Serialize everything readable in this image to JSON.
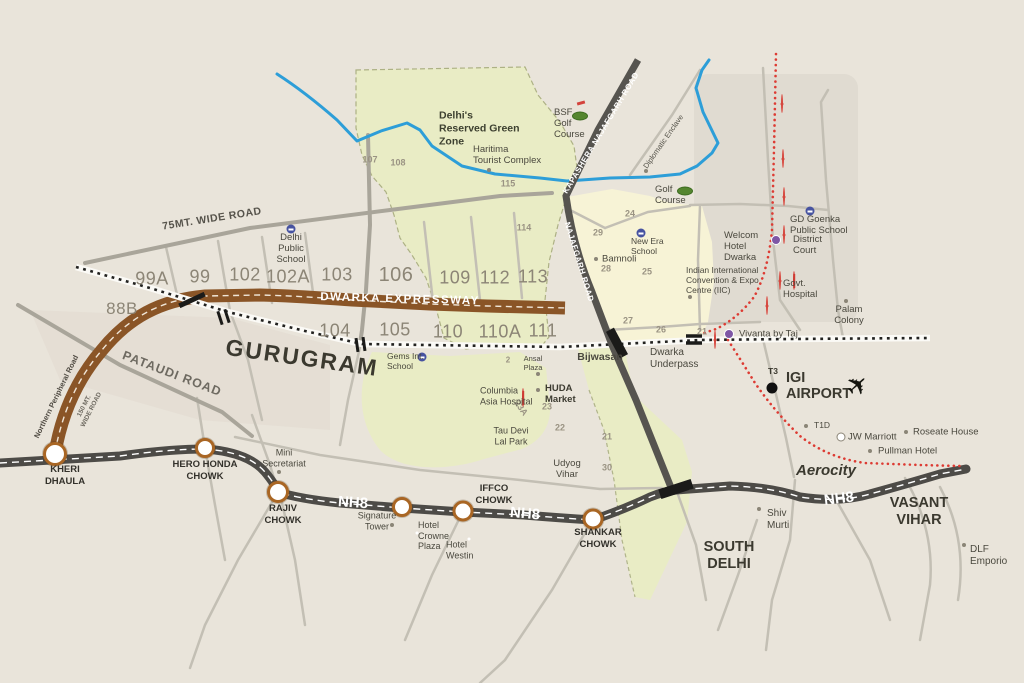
{
  "areas": {
    "gurugram": "GURUGRAM",
    "south_delhi": "SOUTH\nDELHI",
    "vasant_vihar": "VASANT\nVIHAR",
    "aerocity": "Aerocity",
    "bijwasan": "Bijwasan",
    "dwarka_underpass": "Dwarka\nUnderpass",
    "udyog_vihar": "Udyog\nVihar",
    "palam_colony": "Palam\nColony",
    "diplomatic_enclave": "Diplomatic Enclave",
    "green_zone": "Delhi's\nReserved Green\nZone",
    "bamnoli": "Bamnoli"
  },
  "roads": {
    "dwarka_expressway": "DWARKA EXPRESSWAY",
    "nh8": "NH8",
    "pataudi": "PATAUDI ROAD",
    "wide75": "75MT. WIDE ROAD",
    "wide150": "150 MT.\nWIDE ROAD",
    "npr": "Northern Peripheral Road",
    "kapashera": "KAPASHERA NAJAFGARH ROAD",
    "najafgarh": "NAJAFGARH ROAD"
  },
  "junctions": {
    "kheri": "KHERI\nDHAULA",
    "hero": "HERO HONDA\nCHOWK",
    "rajiv": "RAJIV\nCHOWK",
    "iffco": "IFFCO\nCHOWK",
    "shankar": "SHANKAR\nCHOWK"
  },
  "places": {
    "dps": "Delhi\nPublic\nSchool",
    "haritima": "Haritima\nTourist Complex",
    "bsf_golf": "BSF\nGolf\nCourse",
    "golf": "Golf\nCourse",
    "new_era": "New Era\nSchool",
    "welcom": "Welcom\nHotel\nDwarka",
    "iicc": "Indian International\nConvention & Expo\nCentre (IIC)",
    "gd_goenka": "GD Goenka\nPublic School",
    "district_court": "District\nCourt",
    "govt_hospital": "Govt.\nHospital",
    "vivanta": "Vivanta by Taj",
    "gems": "Gems Int.\nSchool",
    "columbia": "Columbia\nAsia Hospital",
    "huda": "HUDA\nMarket",
    "ansal": "Ansal\nPlaza",
    "tau_devi": "Tau Devi\nLal Park",
    "mini_sec": "Mini\nSecretariat",
    "signature": "Signature\nTower",
    "crowne": "Hotel\nCrowne\nPlaza",
    "westin": "Hotel\nWestin",
    "igi": "IGI\nAIRPORT",
    "t3": "T3",
    "t1d": "T1D",
    "jw": "JW Marriott",
    "roseate": "Roseate House",
    "pullman": "Pullman Hotel",
    "shiv_murti": "Shiv\nMurti",
    "dlf": "DLF\nEmporio"
  },
  "sectors": {
    "s99a": "99A",
    "s99": "99",
    "s102": "102",
    "s102a": "102A",
    "s103": "103",
    "s106": "106",
    "s109": "109",
    "s112": "112",
    "s113": "113",
    "s88b": "88B",
    "s104": "104",
    "s105": "105",
    "s110": "110",
    "s110a": "110A",
    "s111": "111",
    "s107": "107",
    "s108": "108",
    "s115": "115",
    "s114": "114",
    "s24": "24",
    "s29": "29",
    "s28": "28",
    "s25": "25",
    "s27": "27",
    "s26": "26",
    "s21a": "21",
    "s23": "23",
    "s23a": "23A",
    "s22": "22",
    "s21b": "21",
    "s30": "30",
    "s2": "2"
  },
  "colors": {
    "expressway_brown": "#8a5527",
    "nh8_gray": "#4d4b47",
    "metro_red": "#dd3b33",
    "river_blue": "#2d9ed8",
    "green_zone_fill": "#e9ecc5",
    "dwarka_yellow_fill": "#f7f3d6",
    "background": "#e9e4da"
  }
}
